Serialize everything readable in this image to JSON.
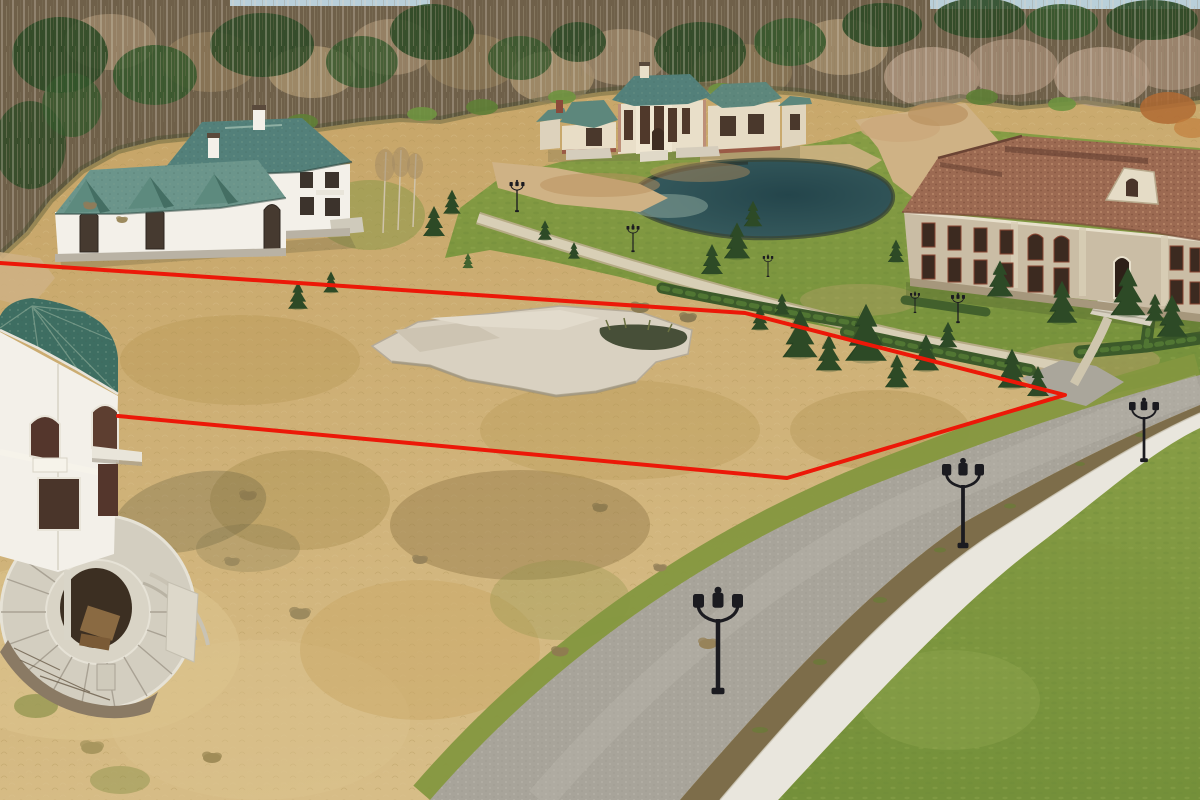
{
  "scene": {
    "type": "aerial-drone-photograph",
    "description": "Aerial view of a vacant land plot outlined with a red boundary line in an unfinished luxury cottage settlement at a forest edge in early spring; dry tan grass plot with an abandoned concrete foundation slab, surrounded by unfinished mansions, a dark pond, green lawns, hedges, a curved cobblestone road with a white sidewalk and ornate street lamps",
    "annotation": {
      "label": "red plot boundary outline",
      "points": "0,263 745,313 1065,395 787,478 118,416",
      "color": "#ec1808",
      "stroke_width": 4
    },
    "palette": {
      "sky": "#b9cfd9",
      "forest_base": "#6f6049",
      "conifer": "#2d4a26",
      "conifer_light": "#3b5e2e",
      "birch": "#a28b6d",
      "dry_grass": "#c3a061",
      "dry_grass_light": "#d7bd87",
      "lawn": "#879d45",
      "lawn_dark": "#74903a",
      "pond_deep": "#24454b",
      "pond_mid": "#35595c",
      "pond_edge": "#7fa49b",
      "sand": "#cfb285",
      "road": "#a8a49a",
      "road_light": "#bdb9ae",
      "planting_strip": "#7d6d4a",
      "sidewalk": "#e9e6dd",
      "hedge": "#3c5a2a",
      "roof_green": "#53807a",
      "roof_green_light": "#6b958b",
      "wall_white": "#f3f0e9",
      "roof_terracotta": "#9c6a52",
      "wall_stone": "#cabda5",
      "turret_roof": "#3e6e62",
      "slab": "#d9d1c1",
      "lamp": "#1b1b20"
    },
    "objects": {
      "left_house": "two-storey white house with green hip roof and gabled one-storey wing, upper left",
      "center_mansion": "unfinished beige mansion with green roofs behind the pond, top center",
      "right_mansion": "large beige stone mansion with speckled terracotta roof and pediment, upper right",
      "turret_house": "unfinished white turret with green shingle roof and curved grand staircase, lower left",
      "pond": "dark teal pond with sandy banks, center top",
      "concrete_slab": "abandoned light concrete foundation slab inside the plot",
      "plot_field": "dry tan grass plot outlined in red",
      "main_road": "curved cobblestone road, bottom right",
      "sidewalk": "white concrete sidewalk parallel to the road",
      "footpath": "light gravel footpath between plot and lawns",
      "hedges": "trimmed hedge rows along paths",
      "forest": "bare birch and conifer forest band across the top"
    },
    "trees": {
      "conifers": [
        [
          434,
          224,
          1.0
        ],
        [
          452,
          204,
          0.8
        ],
        [
          298,
          298,
          0.9
        ],
        [
          331,
          284,
          0.7
        ],
        [
          712,
          262,
          1.0
        ],
        [
          737,
          244,
          1.2
        ],
        [
          753,
          216,
          0.85
        ],
        [
          800,
          338,
          1.6
        ],
        [
          829,
          356,
          1.2
        ],
        [
          866,
          338,
          1.9
        ],
        [
          897,
          374,
          1.1
        ],
        [
          926,
          356,
          1.2
        ],
        [
          760,
          320,
          0.8
        ],
        [
          782,
          306,
          0.7
        ],
        [
          1012,
          372,
          1.3
        ],
        [
          1038,
          384,
          1.0
        ],
        [
          1000,
          282,
          1.2
        ],
        [
          1062,
          306,
          1.4
        ],
        [
          1128,
          296,
          1.6
        ],
        [
          1172,
          320,
          1.4
        ],
        [
          948,
          337,
          0.85
        ],
        [
          896,
          253,
          0.75
        ],
        [
          1155,
          310,
          0.9
        ],
        [
          545,
          232,
          0.65
        ],
        [
          574,
          252,
          0.55
        ],
        [
          468,
          262,
          0.5,
          "#41632f"
        ]
      ],
      "bushes": [
        [
          640,
          308,
          1.0,
          "#8a7a52"
        ],
        [
          688,
          318,
          0.9,
          "#8a7a52"
        ],
        [
          300,
          614,
          1.1,
          "#9c8a5e"
        ],
        [
          248,
          496,
          0.9,
          "#8f7c50"
        ],
        [
          708,
          644,
          1.0,
          "#97835a"
        ],
        [
          600,
          508,
          0.8,
          "#8f7c50"
        ],
        [
          660,
          568,
          0.7,
          "#97835a"
        ],
        [
          232,
          562,
          0.8,
          "#9c8a5e"
        ],
        [
          92,
          748,
          1.2,
          "#a8965e"
        ],
        [
          212,
          758,
          1.0,
          "#a08c58"
        ],
        [
          560,
          652,
          0.9,
          "#8f7c50"
        ],
        [
          420,
          560,
          0.8,
          "#97835a"
        ],
        [
          90,
          206,
          0.7,
          "#8f7c5a"
        ],
        [
          122,
          220,
          0.6,
          "#9c8a5e"
        ]
      ]
    },
    "street_lamps": {
      "style": "black ornate double-lantern posts",
      "count": 8,
      "items": [
        {
          "x": 718,
          "y": 694,
          "h": 100
        },
        {
          "x": 963,
          "y": 548,
          "h": 84
        },
        {
          "x": 1144,
          "y": 462,
          "h": 60
        },
        {
          "x": 517,
          "y": 212,
          "h": 30
        },
        {
          "x": 633,
          "y": 252,
          "h": 26
        },
        {
          "x": 768,
          "y": 277,
          "h": 21
        },
        {
          "x": 915,
          "y": 313,
          "h": 20
        },
        {
          "x": 958,
          "y": 323,
          "h": 28
        }
      ]
    }
  }
}
